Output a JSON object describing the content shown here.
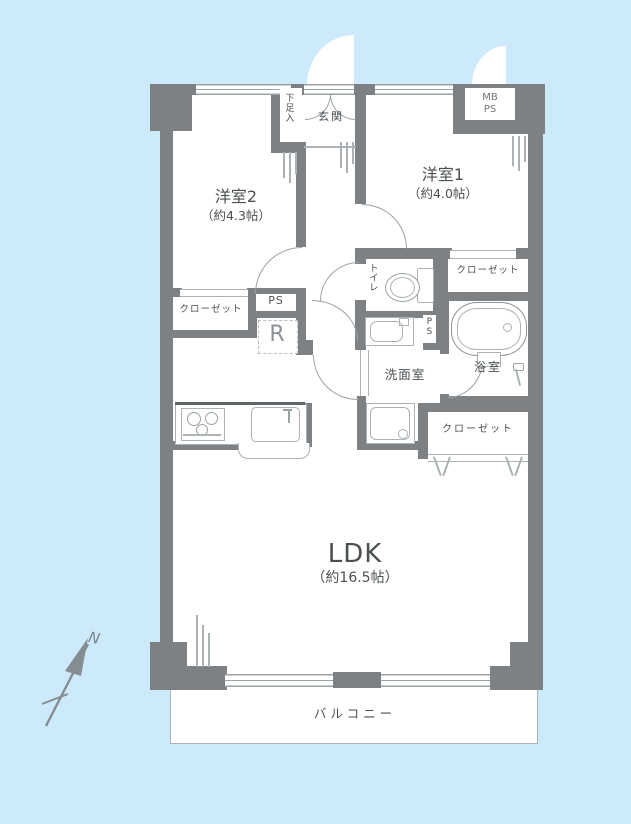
{
  "plan": {
    "type": "apartment-floor-plan",
    "rooms": {
      "west2": {
        "name": "洋室2",
        "size": "（約4.3帖）"
      },
      "west1": {
        "name": "洋室1",
        "size": "（約4.0帖）"
      },
      "ldk": {
        "name": "LDK",
        "size": "（約16.5帖）"
      },
      "toilet": {
        "name": "トイレ"
      },
      "washroom": {
        "name": "洗面室"
      },
      "bathroom": {
        "name": "浴室"
      },
      "balcony": {
        "name": "バルコニー"
      }
    },
    "entrance": {
      "hall": "玄関",
      "shoe_cabinet": "下足入"
    },
    "meter_box": {
      "line1": "MB",
      "line2": "PS"
    },
    "storage": {
      "closet_west2": "クローゼット",
      "closet_west1": "クローゼット",
      "closet_ldk": "クローゼット",
      "pipe_space_main": "PS",
      "pipe_space_bath": "PS",
      "refrigerator": "R"
    },
    "compass": {
      "north": "N"
    },
    "colors": {
      "background": "#cdeafa",
      "wall": "#7d8184",
      "fixture_line": "#9aa2a6",
      "text": "#4b5053"
    }
  }
}
